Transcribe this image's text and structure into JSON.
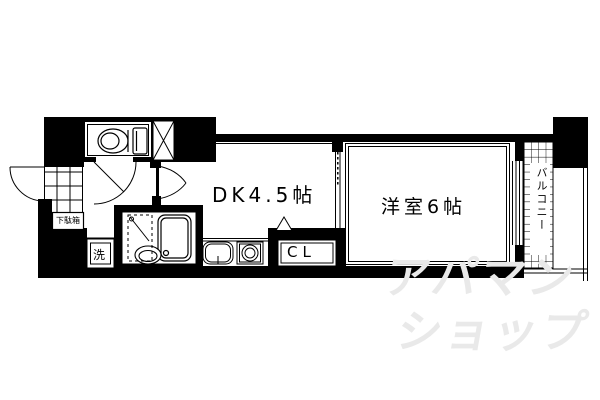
{
  "floorplan": {
    "rooms": {
      "dk": "DK4.5帖",
      "western": "洋室6帖",
      "closet": "CL",
      "balcony": "バルコニー",
      "shoe_box": "下駄箱",
      "washer": "洗"
    },
    "watermark": {
      "line1": "アパマン",
      "line2": "ショップ"
    },
    "colors": {
      "wall": "#000000",
      "background": "#ffffff",
      "watermark": "#e9e9e9"
    }
  }
}
